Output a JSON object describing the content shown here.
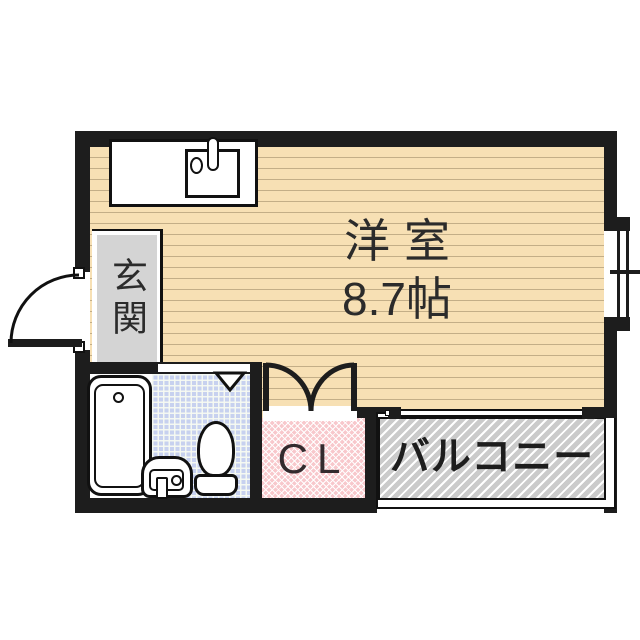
{
  "plan": {
    "type": "apartment-floor-plan",
    "rooms": {
      "main_room": {
        "name_label": "洋室",
        "size_label": "8.7帖",
        "floor_color": "#f7e0b4",
        "floor_pattern": "horizontal-wood-stripes"
      },
      "entrance": {
        "label": "玄関",
        "floor_color": "#d4d4d4"
      },
      "bathroom": {
        "tile_color": "#c7d1ef",
        "tile_pattern": "square-grid",
        "fixtures": [
          "bathtub-icon",
          "washbasin-icon",
          "toilet-icon"
        ]
      },
      "closet": {
        "label": "CL",
        "floor_color": "#f8c8cc",
        "floor_pattern": "diagonal-crosshatch",
        "doors": "double-swing"
      },
      "balcony": {
        "label": "バルコニー",
        "floor_color": "#cbcbcb",
        "floor_pattern": "diagonal-hatch"
      },
      "kitchen": {
        "fixtures": [
          "kitchen-counter-icon",
          "kitchen-sink-icon",
          "faucet-icon"
        ]
      }
    },
    "colors": {
      "wall": "#1d1d1d",
      "background": "#ffffff",
      "text": "#2b2b2b"
    }
  }
}
